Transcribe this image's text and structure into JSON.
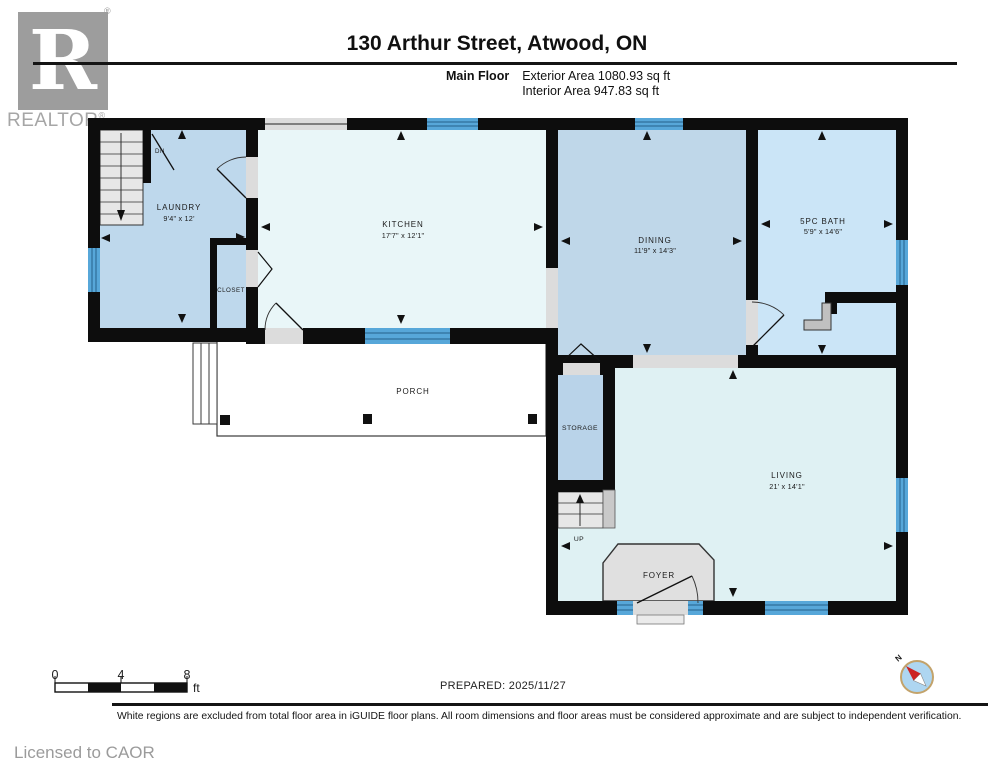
{
  "header": {
    "logo": {
      "letter": "R",
      "label": "REALTOR",
      "reg_mark": "®"
    },
    "title": "130 Arthur Street, Atwood, ON",
    "floor_label": "Main Floor",
    "exterior_area": "Exterior Area 1080.93 sq ft",
    "interior_area": "Interior Area 947.83 sq ft"
  },
  "plan": {
    "rooms": {
      "laundry": {
        "label": "LAUNDRY",
        "dims": "9'4\" x 12'"
      },
      "kitchen": {
        "label": "KITCHEN",
        "dims": "17'7\" x 12'1\""
      },
      "dining": {
        "label": "DINING",
        "dims": "11'9\" x 14'3\""
      },
      "bath": {
        "label": "5PC BATH",
        "dims": "5'9\" x 14'6\""
      },
      "living": {
        "label": "LIVING",
        "dims": "21' x 14'1\""
      },
      "closet": {
        "label": "CLOSET"
      },
      "storage": {
        "label": "STORAGE"
      },
      "porch": {
        "label": "PORCH"
      },
      "foyer": {
        "label": "FOYER"
      }
    },
    "stairs": {
      "up_label": "UP",
      "down_label": "DN"
    },
    "compass_label": "N"
  },
  "scale_bar": {
    "ticks": [
      "0",
      "4",
      "8"
    ],
    "unit": "ft"
  },
  "footer": {
    "prepared": "PREPARED: 2025/11/27",
    "disclaimer": "White regions are excluded from total floor area in iGUIDE floor plans. All room dimensions and floor areas must be considered approximate and are subject to independent verification.",
    "licensed": "Licensed to CAOR"
  },
  "colors": {
    "wall": "#0d0d0d",
    "room_blue": "#bed8ec",
    "dining_blue": "#bfd7e9",
    "bath_blue": "#cbe5f7",
    "kitchen_pale": "#e9f6f8",
    "living_pale": "#dff1f3",
    "window_blue": "#57a7d9",
    "opening_gray": "#dcdcdc",
    "compass_red": "#cc2222",
    "compass_face": "#aed6f1",
    "compass_ring": "#c3a36b"
  }
}
